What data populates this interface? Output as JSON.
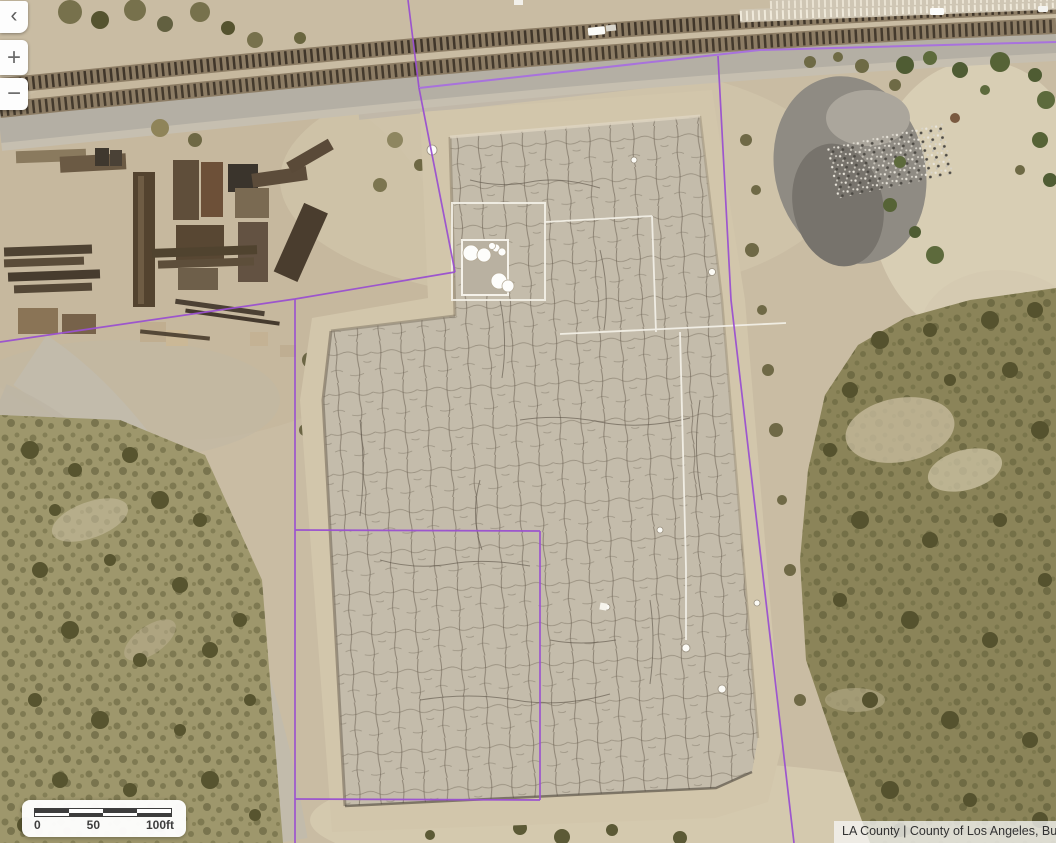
{
  "toolbar": {
    "i_want_to_label": "I want to..."
  },
  "icons": {
    "chevron_left": "‹",
    "zoom_in": "+",
    "zoom_out": "−"
  },
  "scale_bar": {
    "labels": [
      "0",
      "50",
      "100ft"
    ]
  },
  "attribution": {
    "text": "LA County | County of Los Angeles, Bu"
  },
  "colors": {
    "accent_blue": "#1b75bc",
    "parcel_purple": "#9a50d0",
    "scalebar_dark": "#3d3d3d"
  }
}
